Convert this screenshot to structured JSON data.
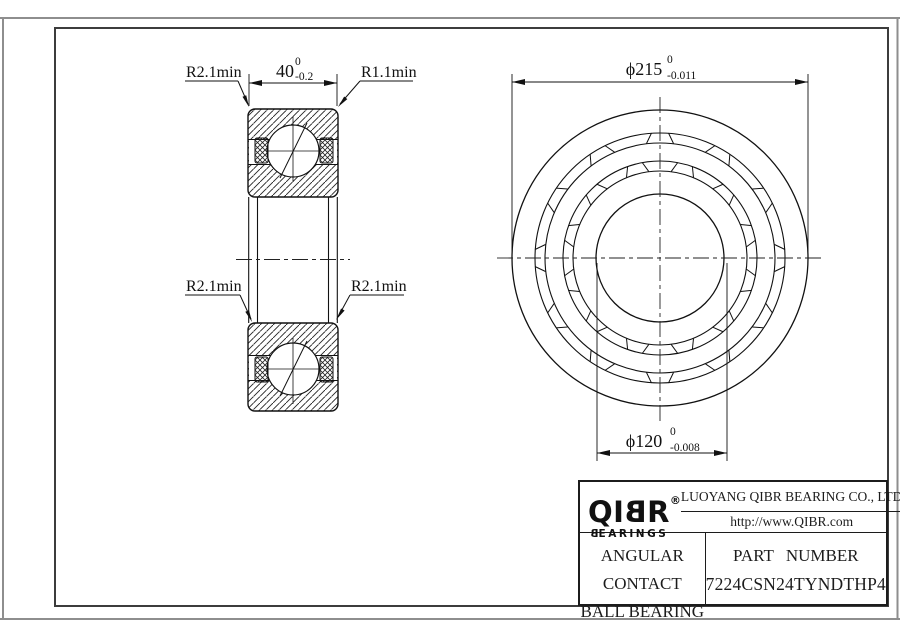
{
  "section_view": {
    "width_dim": {
      "value": "40",
      "tol_upper": "0",
      "tol_lower": "-0.2"
    },
    "corner_labels": {
      "top_left": "R2.1min",
      "top_right": "R1.1min",
      "mid_left": "R2.1min",
      "mid_right": "R2.1min"
    }
  },
  "front_view": {
    "outer_diameter_dim": {
      "value": "ϕ215",
      "tol_upper": "0",
      "tol_lower": "-0.011"
    },
    "bore_diameter_dim": {
      "value": "ϕ120",
      "tol_upper": "0",
      "tol_lower": "-0.008"
    }
  },
  "title_block": {
    "logo": {
      "prefix": "QI",
      "mirrored_letter": "B",
      "suffix": "R",
      "registered": "®",
      "brand_sub_mirrored": "B",
      "brand_sub_rest": "EARINGS"
    },
    "company_name": "LUOYANG QIBR BEARING CO., LTD",
    "website": "http://www.QIBR.com",
    "product_type_line1": "ANGULAR CONTACT",
    "product_type_line2": "BALL BEARING",
    "part_number_label": "PART NUMBER",
    "part_number": "7224CSN24TYNDTHP4"
  }
}
